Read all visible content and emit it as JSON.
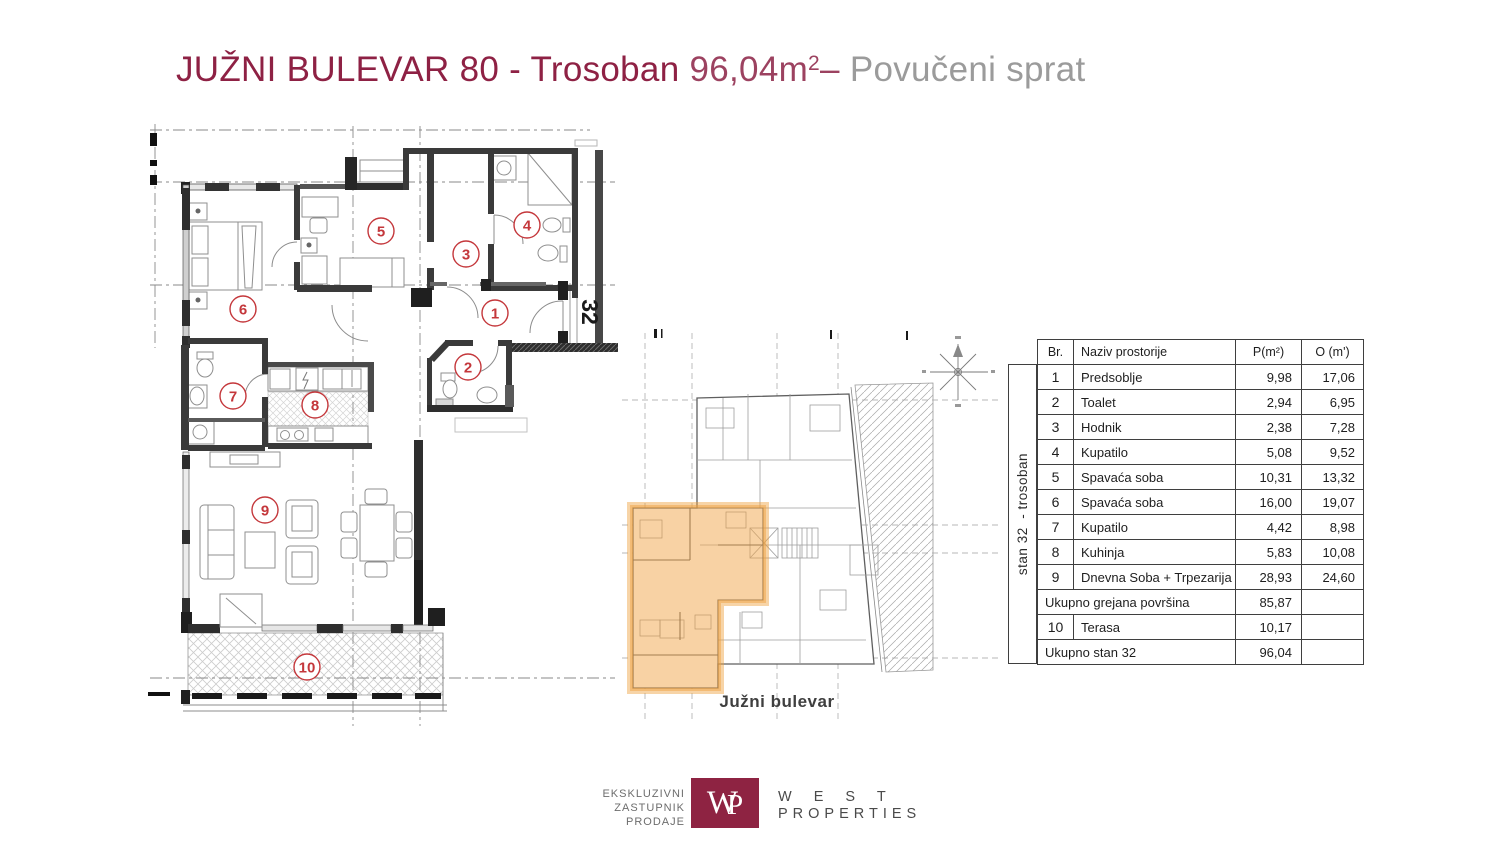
{
  "title": {
    "main": "JUŽNI BULEVAR 80  - Trosoban ",
    "area": "96,04m",
    "area_sup": "2",
    "dash": "– ",
    "floor": "Povučeni sprat"
  },
  "plan": {
    "unit_number": "32",
    "room_numbers": [
      "1",
      "2",
      "3",
      "4",
      "5",
      "6",
      "7",
      "8",
      "9",
      "10"
    ]
  },
  "site_plan": {
    "street_label": "Južni bulevar"
  },
  "table": {
    "header": {
      "br": "Br.",
      "naziv": "Naziv prostorije",
      "p": "P(m²)",
      "o": "O (m')"
    },
    "vertical_label": "stan 32  - trosoban",
    "rows": [
      {
        "br": "1",
        "naziv": "Predsoblje",
        "p": "9,98",
        "o": "17,06"
      },
      {
        "br": "2",
        "naziv": "Toalet",
        "p": "2,94",
        "o": "6,95"
      },
      {
        "br": "3",
        "naziv": "Hodnik",
        "p": "2,38",
        "o": "7,28"
      },
      {
        "br": "4",
        "naziv": "Kupatilo",
        "p": "5,08",
        "o": "9,52"
      },
      {
        "br": "5",
        "naziv": "Spavaća soba",
        "p": "10,31",
        "o": "13,32"
      },
      {
        "br": "6",
        "naziv": "Spavaća soba",
        "p": "16,00",
        "o": "19,07"
      },
      {
        "br": "7",
        "naziv": "Kupatilo",
        "p": "4,42",
        "o": "8,98"
      },
      {
        "br": "8",
        "naziv": "Kuhinja",
        "p": "5,83",
        "o": "10,08"
      },
      {
        "br": "9",
        "naziv": "Dnevna Soba + Trpezarija",
        "p": "28,93",
        "o": "24,60"
      },
      {
        "merged": true,
        "naziv": "Ukupno grejana površina",
        "p": "85,87",
        "o": ""
      },
      {
        "br": "10",
        "naziv": "Terasa",
        "p": "10,17",
        "o": ""
      },
      {
        "merged": true,
        "naziv": "Ukupno stan 32",
        "p": "96,04",
        "o": ""
      }
    ]
  },
  "footer": {
    "tagline": [
      "EKSKLUZIVNI",
      "ZASTUPNIK",
      "PRODAJE"
    ],
    "monogram_w": "W",
    "monogram_p": "P",
    "brand_word1": "W E S T",
    "brand_word2": "PROPERTIES"
  },
  "colors": {
    "maroon": "#8e2144",
    "maroon_light": "#9c4260",
    "gray_text": "#9b9b9b",
    "orange_highlight": "#f2a54a",
    "room_number_red": "#c4373b",
    "logo_maroon": "#8e2342",
    "wall_dark": "#3a3a3a"
  }
}
